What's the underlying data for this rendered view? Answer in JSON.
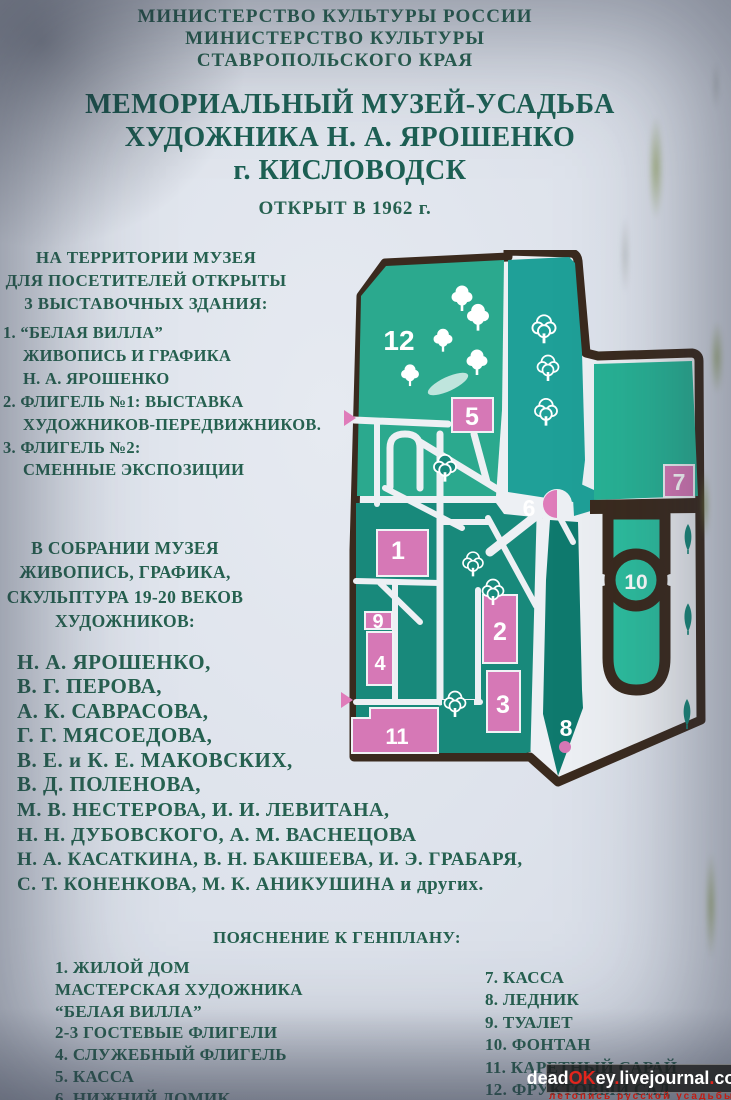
{
  "header": {
    "ministry": [
      "МИНИСТЕРСТВО КУЛЬТУРЫ РОССИИ",
      "МИНИСТЕРСТВО КУЛЬТУРЫ",
      "СТАВРОПОЛЬСКОГО КРАЯ"
    ],
    "title": [
      "МЕМОРИАЛЬНЫЙ МУЗЕЙ-УСАДЬБА",
      "ХУДОЖНИКА Н. А. ЯРОШЕНКО",
      "г. КИСЛОВОДСК"
    ],
    "opened": "ОТКРЫТ В 1962 г."
  },
  "intro": [
    "НА ТЕРРИТОРИИ МУЗЕЯ",
    "ДЛЯ ПОСЕТИТЕЛЕЙ ОТКРЫТЫ",
    "3 ВЫСТАВОЧНЫХ ЗДАНИЯ:"
  ],
  "buildings": [
    "1. “БЕЛАЯ ВИЛЛА”",
    "ЖИВОПИСЬ И ГРАФИКА",
    "Н. А. ЯРОШЕНКО",
    "2. ФЛИГЕЛЬ №1: ВЫСТАВКА",
    "ХУДОЖНИКОВ-ПЕРЕДВИЖНИКОВ.",
    "3. ФЛИГЕЛЬ №2:",
    "СМЕННЫЕ ЭКСПОЗИЦИИ"
  ],
  "collection": [
    "В СОБРАНИИ МУЗЕЯ",
    "ЖИВОПИСЬ, ГРАФИКА,",
    "СКУЛЬПТУРА 19-20 ВЕКОВ",
    "ХУДОЖНИКОВ:"
  ],
  "artists": [
    "Н. А. ЯРОШЕНКО,",
    "В. Г. ПЕРОВА,",
    "А. К. САВРАСОВА,",
    "Г. Г. МЯСОЕДОВА,",
    "В. Е.  и К. Е. МАКОВСКИХ,",
    "В. Д. ПОЛЕНОВА,",
    "М. В. НЕСТЕРОВА, И. И. ЛЕВИТАНА,",
    "Н. Н. ДУБОВСКОГО, А. М. ВАСНЕЦОВА",
    "Н. А. КАСАТКИНА, В. Н. БАКШЕЕВА, И. Э. ГРАБАРЯ,",
    "С. Т. КОНЕНКОВА, М. К. АНИКУШИНА и других."
  ],
  "legend": {
    "heading": "ПОЯСНЕНИЕ К ГЕНПЛАНУ:",
    "left": [
      "1. ЖИЛОЙ ДОМ",
      "МАСТЕРСКАЯ ХУДОЖНИКА",
      "“БЕЛАЯ ВИЛЛА”",
      "2-3 ГОСТЕВЫЕ ФЛИГЕЛИ",
      "4. СЛУЖЕБНЫЙ ФЛИГЕЛЬ",
      "5. КАССА",
      "6. НИЖНИЙ ДОМИК"
    ],
    "right": [
      "7. КАССА",
      "8. ЛЕДНИК",
      "9. ТУАЛЕТ",
      "10. ФОНТАН",
      "11. КАРЕТНЫЙ САРАЙ",
      "12. ФРУКТОВЫЙ САД"
    ]
  },
  "map": {
    "labels": {
      "b1": "1",
      "b2": "2",
      "b3": "3",
      "b4": "4",
      "b5": "5",
      "b6": "6",
      "b7": "7",
      "b8": "8",
      "b9": "9",
      "b10": "10",
      "b11": "11",
      "b12": "12"
    }
  },
  "watermark": {
    "p1": "dead",
    "p2": "OK",
    "p3": "ey",
    "p4": ".",
    "p5": "livejournal",
    "p6": ".",
    "p7": "com",
    "tagline": "летопись русской усадьбы"
  },
  "colors": {
    "text_green": "#266150",
    "title_green": "#1d6054",
    "outline_brown": "#3a2a1e",
    "teal_orchard": "#2ba98e",
    "teal_band": "#1fa098",
    "teal_dark": "#18897b",
    "teal_dark2": "#0f7a6e",
    "teal_parcel": "#27b295",
    "teal_fountain": "#2cbd9e",
    "building_pink": "#d678b6",
    "marker_pink": "#df7cba",
    "watermark_red": "#e2251d"
  }
}
